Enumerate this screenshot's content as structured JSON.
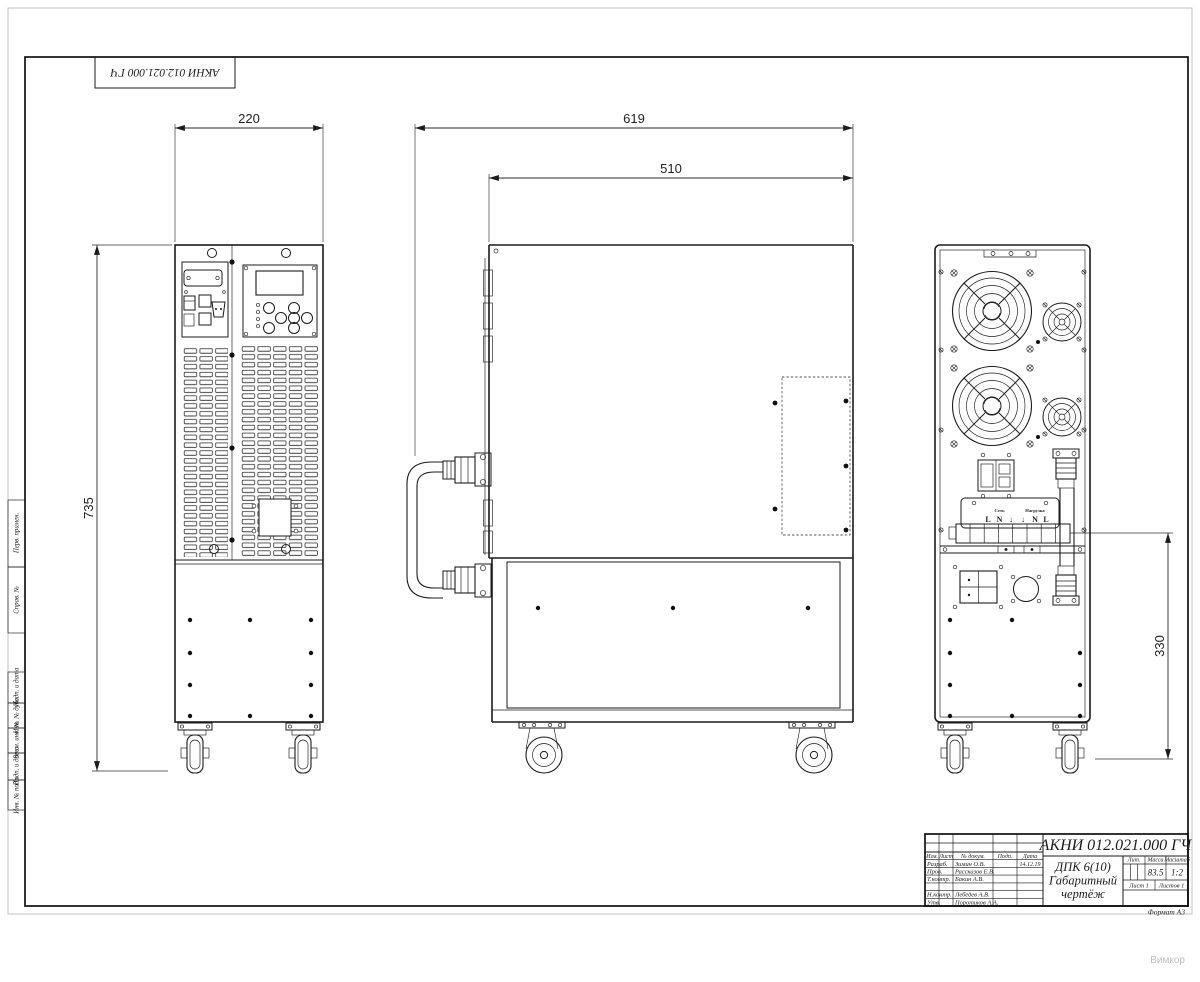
{
  "doc": {
    "number": "АКНИ 012.021.000 ГЧ",
    "product": "ДПК 6(10)",
    "type_line1": "Габаритный",
    "type_line2": "чертёж",
    "format": "Формат А3"
  },
  "title_block": {
    "cols": [
      "Изм.",
      "Лист",
      "№ докум.",
      "Подп.",
      "Дата"
    ],
    "rows": [
      {
        "role": "Разраб.",
        "name": "Зимин О.В.",
        "date": "14.12.19"
      },
      {
        "role": "Пров.",
        "name": "Рассказов Е.В.",
        "date": ""
      },
      {
        "role": "Т.контр.",
        "name": "Бакин А.В.",
        "date": ""
      },
      {
        "role": "Н.контр.",
        "name": "Лебедев А.В.",
        "date": ""
      },
      {
        "role": "Утв.",
        "name": "Поротиков А.А.",
        "date": ""
      }
    ],
    "lit_label": "Лит.",
    "mass_label": "Масса",
    "scale_label": "Масштаб",
    "mass": "83.5",
    "scale": "1:2",
    "sheet": "Лист 1",
    "sheets": "Листов 1"
  },
  "margin_labels": [
    "Перв. примен.",
    "Справ. №",
    "Подп. и дата",
    "Инв. № дубл.",
    "Взам. инв. №",
    "Подп. и дата",
    "Инв. № подл."
  ],
  "dimensions": {
    "front_width": "220",
    "depth_overall": "619",
    "depth_body": "510",
    "height_overall": "735",
    "terminal_height": "330"
  },
  "rear_labels": {
    "input_group": "Сеть",
    "output_group": "Нагрузка",
    "pins": [
      "L",
      "N",
      "↓",
      "↓",
      "N",
      "L"
    ]
  },
  "watermark": "Вимкор"
}
